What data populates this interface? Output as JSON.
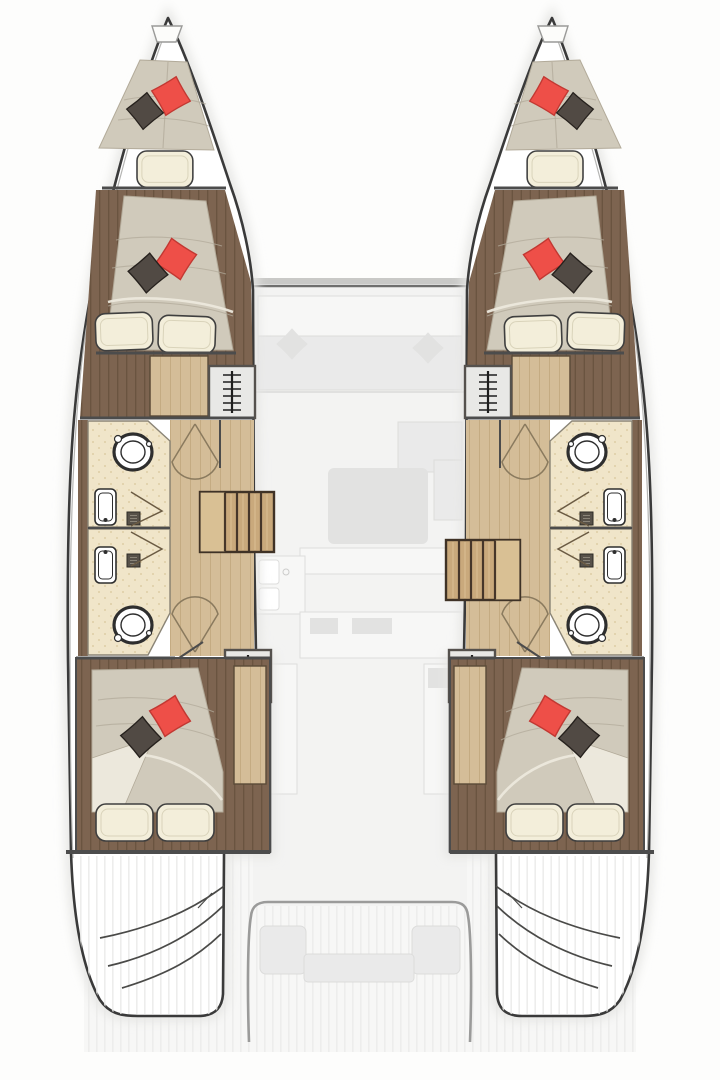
{
  "plan": {
    "description": "Catamaran interior layout floor plan",
    "vessel_type": "catamaran",
    "view": "top-down deck plan, lower-deck cabins over ghosted upper deck",
    "cabins": 4,
    "heads": 4,
    "forepeak_berths": 2,
    "hulls": [
      "port",
      "starboard"
    ],
    "hull_layout_bow_to_stern": [
      "forepeak berth",
      "forward double cabin",
      "companionway ladder",
      "forward head",
      "aft head",
      "saloon stairs",
      "companionway ladder",
      "aft double cabin",
      "transom swim steps"
    ],
    "center_bridgedeck": [
      "saloon (ghosted)",
      "cockpit (ghosted)"
    ]
  },
  "symbols": {
    "companionway-ladder-icon": "vertical rail with rungs",
    "toilet": "double ellipse bowl",
    "sink": "rounded rectangle with faucet dot",
    "shower-drain": "dark grid square",
    "door-swing-arc": "sector cone",
    "stairs": "wood treads with riser lines",
    "pillow": "rotated diamond cushion"
  },
  "colors": {
    "background": "#fdfdfc",
    "hull_fill": "#ffffff",
    "hull_line": "#3a3a3a",
    "sheer_line": "#b5b5b3",
    "halo": "#e6e6e4",
    "wall": "#4c4c4c",
    "wood_dark": "#7d6450",
    "wood_dark_line": "#6a5440",
    "wood_light": "#d4bd98",
    "wood_light_line": "#c4ab82",
    "stairs_wood": "#c9a97c",
    "stairs_landing": "#d9c094",
    "ladder_box": "#e8e8e6",
    "ladder_line": "#1e1e1e",
    "box_border": "#55514d",
    "bath_floor": "#f0e5c9",
    "bath_speckle": "#d9c69a",
    "fixture_line": "#2e2e2e",
    "mattress": "#d0cabb",
    "mattress_line": "#b2aa99",
    "sheet": "#ece8dc",
    "pillow_red": "#ee4f48",
    "pillow_red_dark": "#c23832",
    "pillow_dark": "#514a44",
    "pillow_cream": "#f3eeda",
    "pillow_outline": "#3f3f3f",
    "door_arc": "#8a7a5e",
    "ghost_bg": "#f3f3f2",
    "deck_bg": "#f7f7f6",
    "ghost_fill": "#eaeaea",
    "ghost_fill2": "#e2e2e1",
    "ghost_line": "#dcdcdb",
    "plank_line": "#e9e9e7",
    "cockpit_line": "#9b9b9a"
  }
}
